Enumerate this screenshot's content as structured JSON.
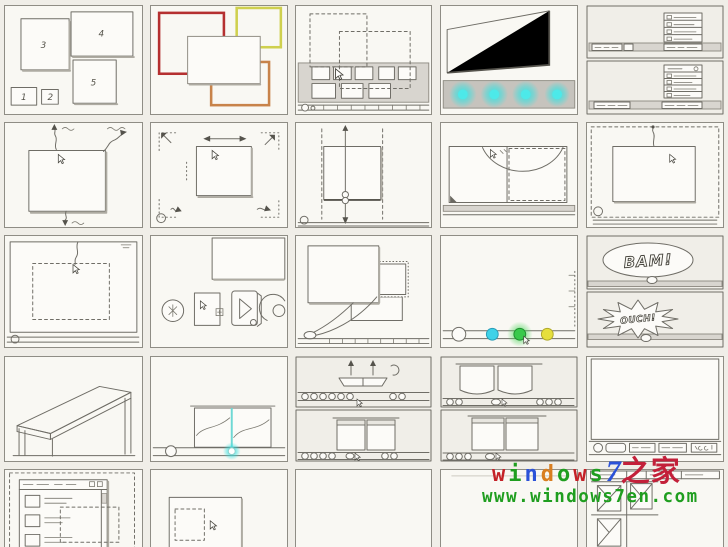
{
  "storyboard": {
    "zorder_labels": [
      "1",
      "2",
      "3",
      "4",
      "5"
    ],
    "bam_text": "BAM!",
    "ouch_text": "OUCH!"
  },
  "colors": {
    "red_frame": "#b53030",
    "yellow_frame": "#cfd04e",
    "orange_frame": "#c8834a",
    "cyan_glow": "#35e2e2",
    "cyan_divider": "#6fd8d4",
    "cyan_bench": "#ddf1ec",
    "dot_cyan": "#3ed2e8",
    "dot_green": "#39c94b",
    "dot_yellow": "#e6df3d",
    "green_glow": "#3fd24f"
  },
  "panels": [
    "window-zorder-sketch",
    "colored-frames-sketch",
    "taskbar-hover-sketch",
    "glass-taskbar-glow-sketch",
    "jumplist-sketches",
    "window-min-max-sketch",
    "window-move-sketch",
    "window-vertical-resize-sketch",
    "aero-snap-arc-sketch",
    "drag-to-top-sketch",
    "window-restore-sketch",
    "app-icons-sketch",
    "minimize-animation-sketch",
    "taskbar-color-dots-sketch",
    "comic-bam-ouch-sketch",
    "glass-bench-sketch",
    "aero-peek-thumbnails-sketch",
    "taskbar-thumbnails-sketch-a",
    "taskbar-thumbnails-sketch-b",
    "desktop-taskbar-sketch",
    "explorer-window-sketch",
    "window-selection-sketch",
    "empty-panel",
    "empty-panel",
    "snap-grid-sketch"
  ],
  "watermark": {
    "line1": [
      {
        "ch": "w",
        "color": "#c42127"
      },
      {
        "ch": "i",
        "color": "#1f9e1f"
      },
      {
        "ch": "n",
        "color": "#2b52d8"
      },
      {
        "ch": "d",
        "color": "#d97e20"
      },
      {
        "ch": "o",
        "color": "#1f9e1f"
      },
      {
        "ch": "w",
        "color": "#c42127"
      },
      {
        "ch": "s",
        "color": "#1f9e1f"
      },
      {
        "ch": "7",
        "color": "#2b52d8",
        "class": "wm-seven"
      },
      {
        "ch": "之家",
        "color": "#c3203a",
        "class": "wm-cjk"
      }
    ],
    "line2": {
      "text": "www.windows7en.com",
      "color": "#1f9e1f"
    }
  }
}
